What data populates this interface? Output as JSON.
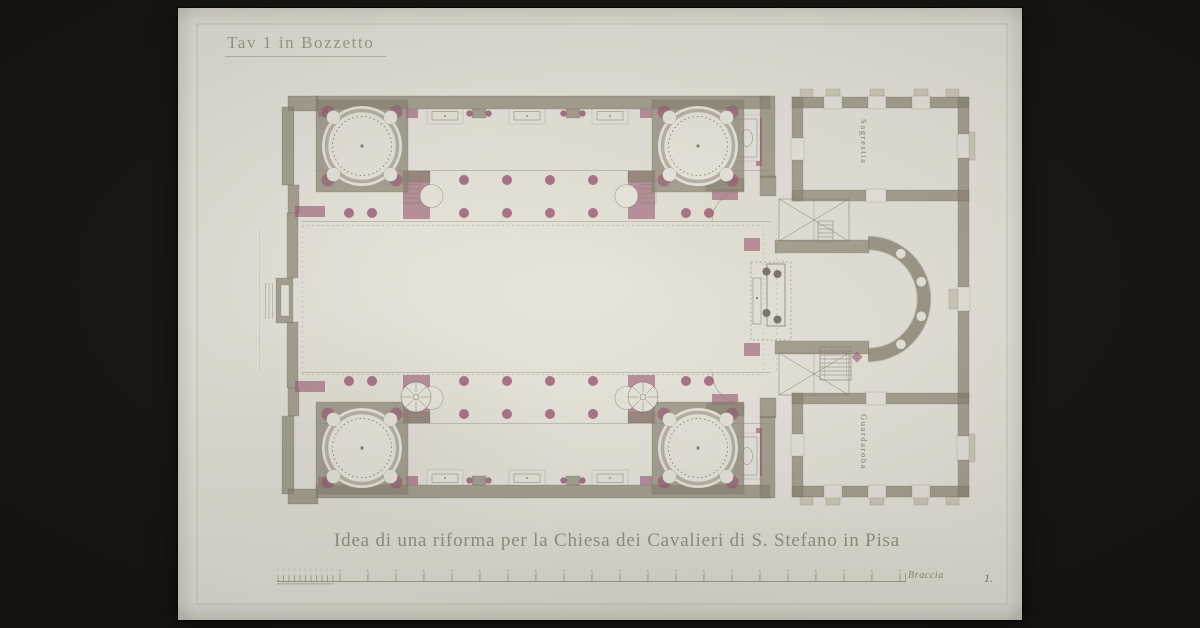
{
  "artwork": {
    "plate_label": "Tav 1 in Bozzetto",
    "caption": "Idea di una riforma per la Chiesa dei Cavalieri di S. Stefano in Pisa",
    "scale_unit_label": "Braccia",
    "plate_number": "1.",
    "room_labels": {
      "sacristy": "Sagrestia",
      "wardrobe": "Guardaroba"
    }
  },
  "colors": {
    "background": "#161310",
    "paper": "#ebe8df",
    "wall": "#8f8876",
    "purple": "#9a5770",
    "ink": "#8b8470"
  }
}
